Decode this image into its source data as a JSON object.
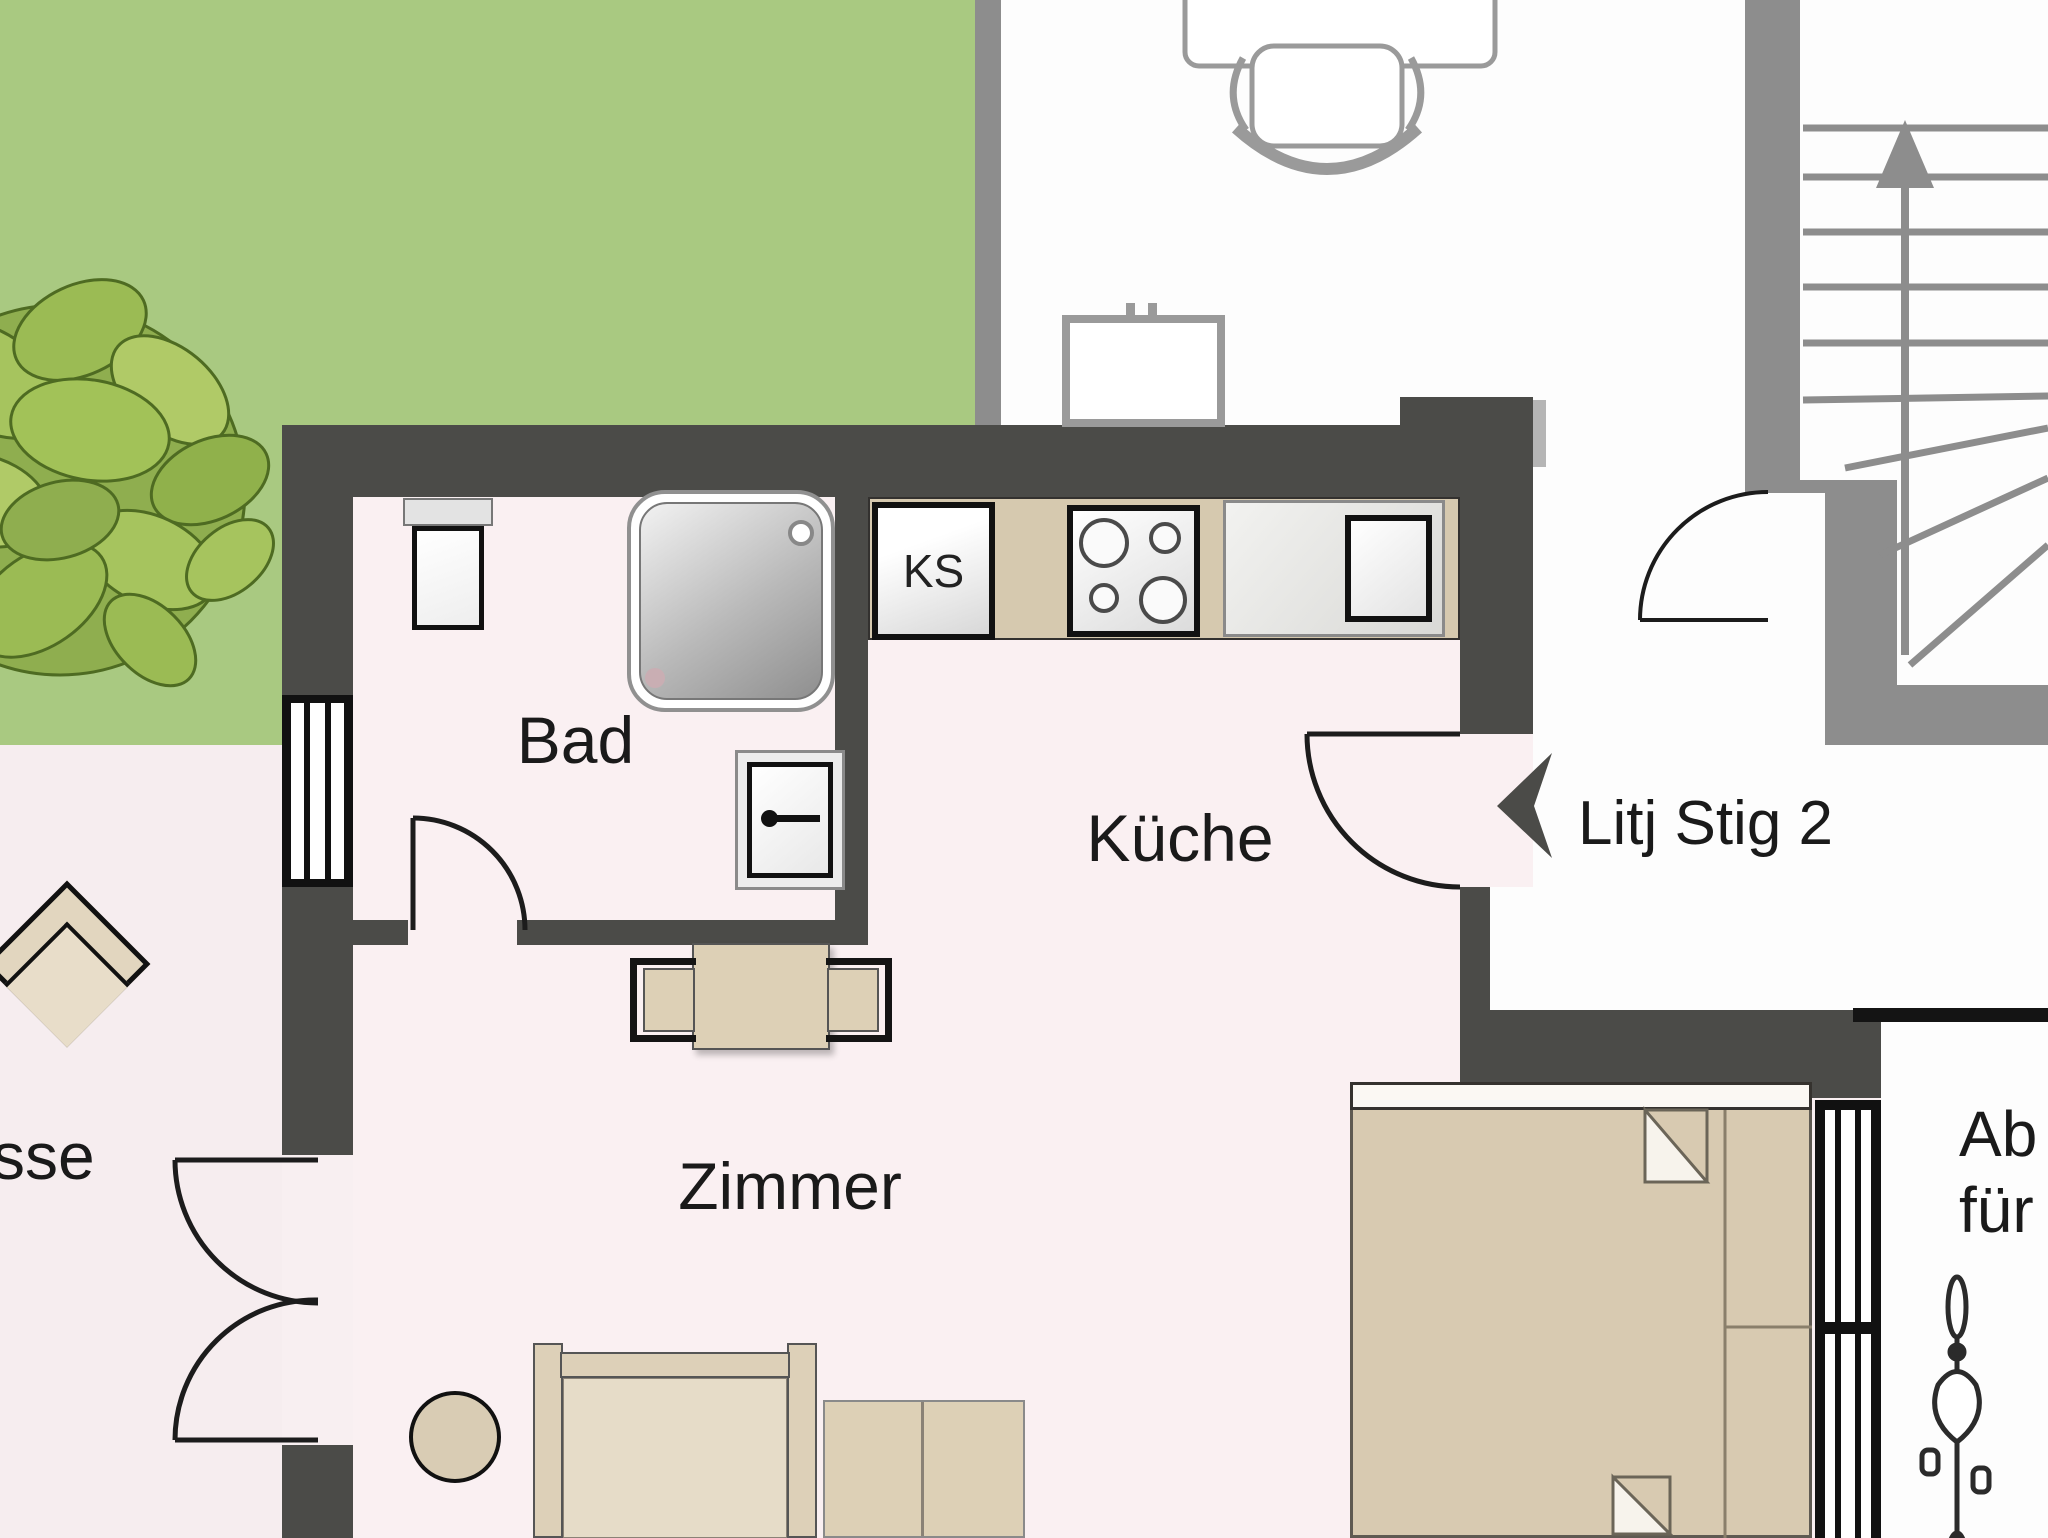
{
  "labels": {
    "bathroom": "Bad",
    "kitchen": "Küche",
    "room": "Zimmer",
    "fridge": "KS",
    "stair_hall": "Litj Stig 2",
    "terrace_partial": "sse",
    "storage_line1": "Ab",
    "storage_line2": "für"
  },
  "colors": {
    "lawn": "#a9c981",
    "wall_dark": "#4b4b48",
    "stair_wall_gray": "#8d8d8d",
    "apartment_floor": "#faf0f2",
    "terrace_floor": "#f6edef",
    "furniture_beige": "#d6c9af",
    "line_black": "#141414"
  }
}
